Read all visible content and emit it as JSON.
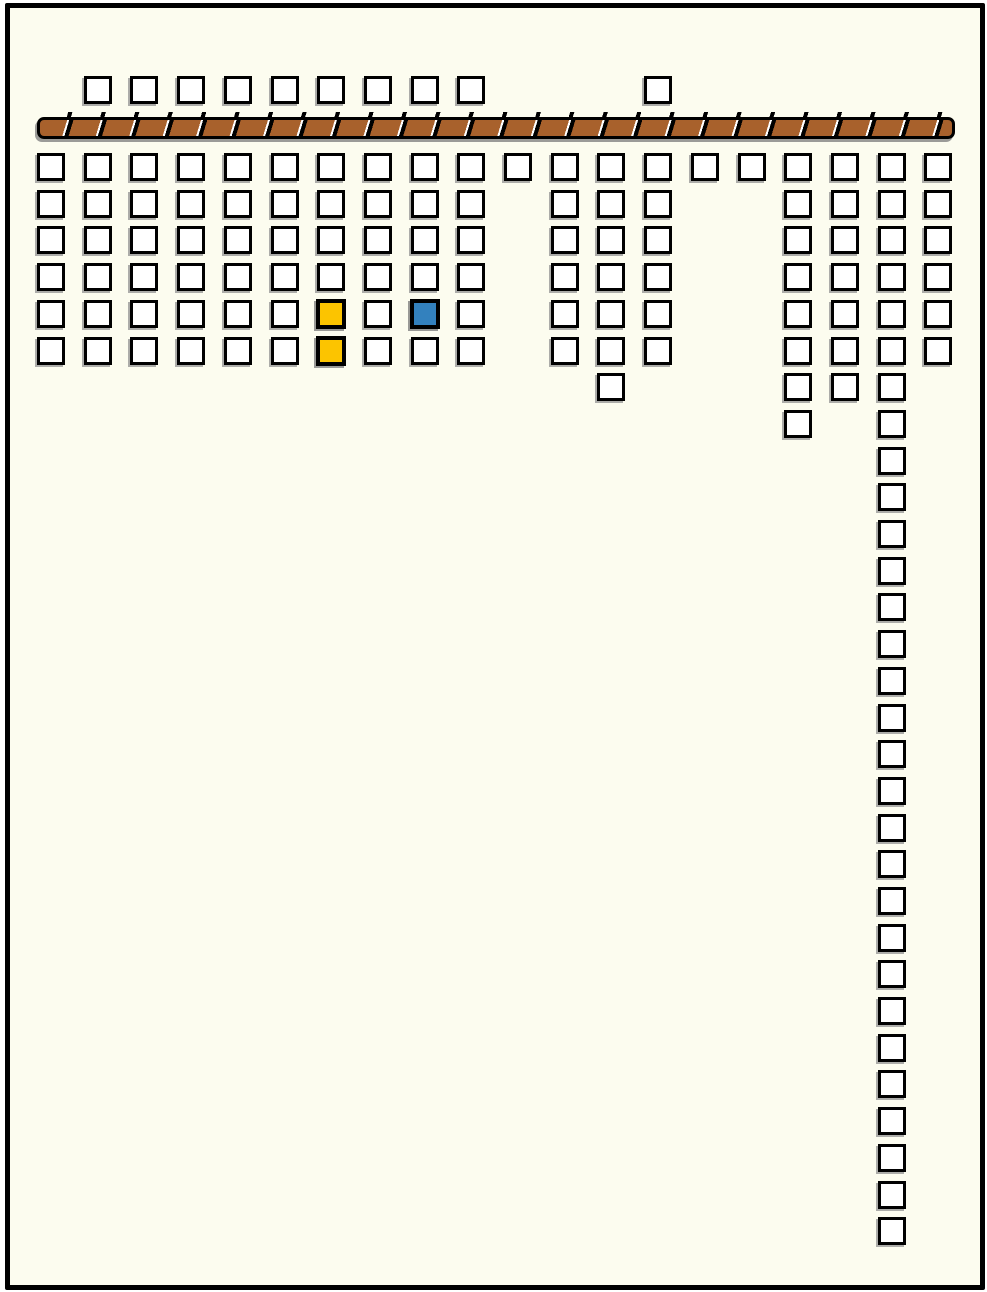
{
  "diagram": {
    "description": "grid-of-squares sketch with hatched wall bar and highlighted cells",
    "canvas": {
      "width": 987,
      "height": 1292
    },
    "frame": {
      "border_color": "#000000",
      "background": "#FCFCEF"
    },
    "square_style": {
      "fill": "#FFFFFF",
      "border": "#000000",
      "outer_size": 28,
      "shadow": "#919191"
    },
    "highlight_colors": {
      "yellow": "#FCC400",
      "blue": "#3381BE"
    },
    "bar": {
      "x": 37,
      "y": 112,
      "width": 918,
      "height": 22,
      "tick_height": 5,
      "fill": "#A8612C",
      "separator": "#000000",
      "highlight": "#FFFFFF",
      "stripe_brown_px": 26,
      "stripe_white_px": 2,
      "stripe_black_px": 4,
      "angle_deg": 107
    },
    "grid": {
      "origin_x": 37,
      "col_spacing": 46.7
    },
    "rows": [
      {
        "name": "above-wall",
        "y": 76,
        "cols": [
          2,
          3,
          4,
          5,
          6,
          7,
          8,
          9,
          10,
          14
        ]
      },
      {
        "name": "row-01",
        "y": 153,
        "cols": [
          1,
          2,
          3,
          4,
          5,
          6,
          7,
          8,
          9,
          10,
          11,
          12,
          13,
          14,
          15,
          16,
          17,
          18,
          19,
          20
        ]
      },
      {
        "name": "row-02",
        "y": 190,
        "cols": [
          1,
          2,
          3,
          4,
          5,
          6,
          7,
          8,
          9,
          10,
          12,
          13,
          14,
          17,
          18,
          19,
          20
        ]
      },
      {
        "name": "row-03",
        "y": 226,
        "cols": [
          1,
          2,
          3,
          4,
          5,
          6,
          7,
          8,
          9,
          10,
          12,
          13,
          14,
          17,
          18,
          19,
          20
        ]
      },
      {
        "name": "row-04",
        "y": 263,
        "cols": [
          1,
          2,
          3,
          4,
          5,
          6,
          7,
          8,
          9,
          10,
          12,
          13,
          14,
          17,
          18,
          19,
          20
        ]
      },
      {
        "name": "row-05",
        "y": 300,
        "cols": [
          1,
          2,
          3,
          4,
          5,
          6,
          7,
          8,
          9,
          10,
          12,
          13,
          14,
          17,
          18,
          19,
          20
        ],
        "colored": {
          "7": "yellow",
          "9": "blue"
        }
      },
      {
        "name": "row-06",
        "y": 337,
        "cols": [
          1,
          2,
          3,
          4,
          5,
          6,
          7,
          8,
          9,
          10,
          12,
          13,
          14,
          17,
          18,
          19,
          20
        ],
        "colored": {
          "7": "yellow"
        }
      },
      {
        "name": "row-07",
        "y": 373,
        "cols": [
          13,
          17,
          18,
          19
        ]
      },
      {
        "name": "row-08",
        "y": 410,
        "cols": [
          17,
          19
        ]
      },
      {
        "name": "row-09",
        "y": 447,
        "cols": [
          19
        ]
      },
      {
        "name": "row-10",
        "y": 483,
        "cols": [
          19
        ]
      },
      {
        "name": "row-11",
        "y": 520,
        "cols": [
          19
        ]
      },
      {
        "name": "row-12",
        "y": 557,
        "cols": [
          19
        ]
      },
      {
        "name": "row-13",
        "y": 593,
        "cols": [
          19
        ]
      },
      {
        "name": "row-14",
        "y": 630,
        "cols": [
          19
        ]
      },
      {
        "name": "row-15",
        "y": 667,
        "cols": [
          19
        ]
      },
      {
        "name": "row-16",
        "y": 704,
        "cols": [
          19
        ]
      },
      {
        "name": "row-17",
        "y": 740,
        "cols": [
          19
        ]
      },
      {
        "name": "row-18",
        "y": 777,
        "cols": [
          19
        ]
      },
      {
        "name": "row-19",
        "y": 814,
        "cols": [
          19
        ]
      },
      {
        "name": "row-20",
        "y": 850,
        "cols": [
          19
        ]
      },
      {
        "name": "row-21",
        "y": 887,
        "cols": [
          19
        ]
      },
      {
        "name": "row-22",
        "y": 924,
        "cols": [
          19
        ]
      },
      {
        "name": "row-23",
        "y": 960,
        "cols": [
          19
        ]
      },
      {
        "name": "row-24",
        "y": 997,
        "cols": [
          19
        ]
      },
      {
        "name": "row-25",
        "y": 1034,
        "cols": [
          19
        ]
      },
      {
        "name": "row-26",
        "y": 1070,
        "cols": [
          19
        ]
      },
      {
        "name": "row-27",
        "y": 1107,
        "cols": [
          19
        ]
      },
      {
        "name": "row-28",
        "y": 1144,
        "cols": [
          19
        ]
      },
      {
        "name": "row-29",
        "y": 1181,
        "cols": [
          19
        ]
      },
      {
        "name": "row-30",
        "y": 1217,
        "cols": [
          19
        ]
      }
    ]
  }
}
